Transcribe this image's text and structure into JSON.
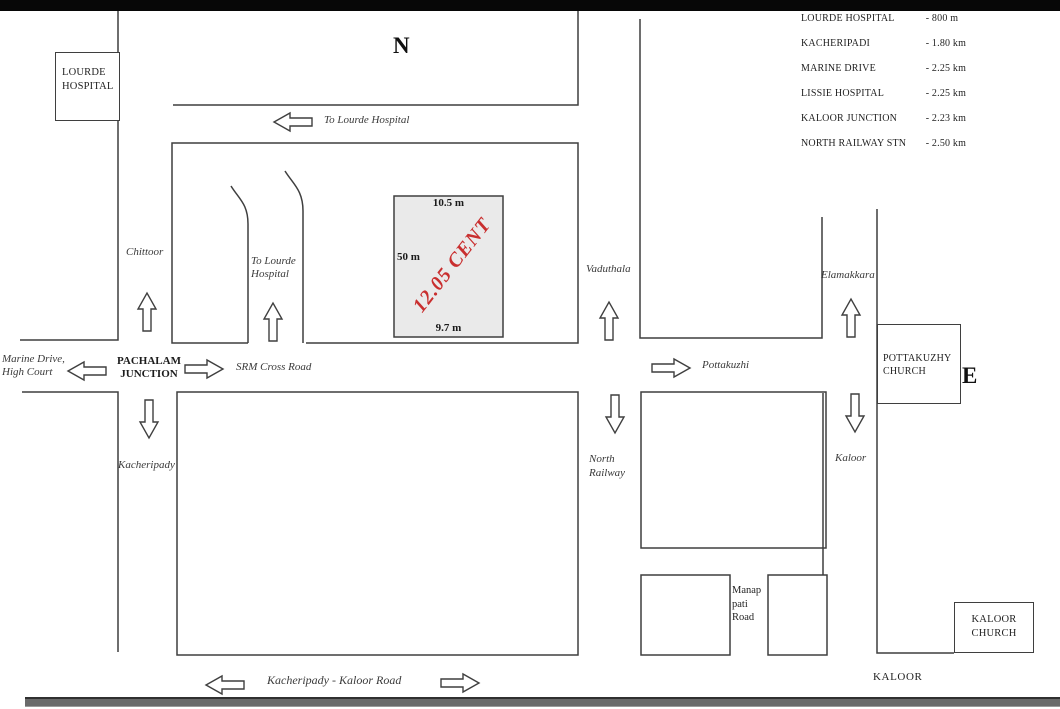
{
  "map": {
    "compass": {
      "north": "N",
      "east": "E"
    },
    "roads": {
      "to_lourde_top": "To Lourde Hospital",
      "chittoor": "Chittoor",
      "to_lourde_inner": "To Lourde Hospital",
      "marine_drive_high_court": "Marine Drive, High Court",
      "pachalam_junction": "PACHALAM JUNCTION",
      "srm_cross_road": "SRM Cross Road",
      "kacheripady": "Kacheripady",
      "vaduthala": "Vaduthala",
      "pottakuzhi": "Pottakuzhi",
      "north_railway": "North Railway",
      "elamakkara": "Elamakkara",
      "kaloor": "Kaloor",
      "manappati_road": "Manap pati Road",
      "kacheripady_kaloor_road": "Kacheripady - Kaloor Road"
    },
    "landmarks": {
      "lourde_hospital": "LOURDE HOSPITAL",
      "pottakuzhy_church": "POTTAKUZHY CHURCH",
      "kaloor_church": "KALOOR CHURCH",
      "kaloor_area": "KALOOR"
    },
    "plot": {
      "area_label": "12.05 CENT",
      "north_dim": "10.5 m",
      "west_dim": "50 m",
      "south_dim": "9.7 m",
      "label_color": "#c92f2f",
      "fill_color": "#eaeaea"
    },
    "distance_table": {
      "rows": [
        {
          "name": "LOURDE HOSPITAL",
          "value": "- 800 m"
        },
        {
          "name": "KACHERIPADI",
          "value": "- 1.80 km"
        },
        {
          "name": "MARINE DRIVE",
          "value": "- 2.25 km"
        },
        {
          "name": "LISSIE HOSPITAL",
          "value": "- 2.25 km"
        },
        {
          "name": "KALOOR JUNCTION",
          "value": "- 2.23 km"
        },
        {
          "name": "NORTH RAILWAY STN",
          "value": "- 2.50 km"
        }
      ]
    },
    "colors": {
      "line": "#3f3f3f"
    }
  }
}
